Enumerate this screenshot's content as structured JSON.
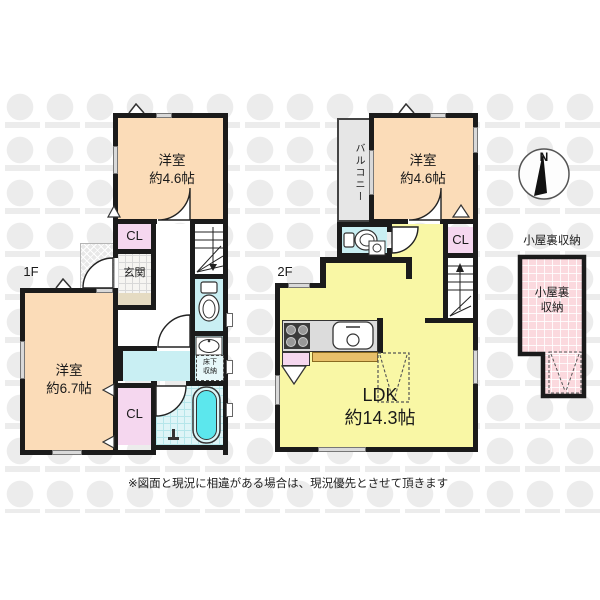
{
  "floor1": {
    "label": "1F",
    "room1": {
      "name": "洋室",
      "size": "約4.6帖"
    },
    "cl1": "CL",
    "genkan": "玄関",
    "room2": {
      "name": "洋室",
      "size": "約6.7帖"
    },
    "cl2": "CL",
    "underfloor": {
      "line1": "床下",
      "line2": "収納"
    }
  },
  "floor2": {
    "label": "2F",
    "balcony": "バルコニー",
    "room": {
      "name": "洋室",
      "size": "約4.6帖"
    },
    "cl": "CL",
    "ldk": {
      "name": "LDK",
      "size": "約14.3帖"
    }
  },
  "attic": {
    "caption": "小屋裏収納",
    "room": {
      "line1": "小屋裏",
      "line2": "収納"
    }
  },
  "compass": {
    "north": "N"
  },
  "footer": {
    "disclaimer": "※図面と現況に相違がある場合は、現況優先とさせて頂きます"
  },
  "colors": {
    "wall": "#1b1b1b",
    "room_peach": "#fbdcb8",
    "ldk_yellow": "#f9f7a5",
    "closet_pink": "#f5d7ef",
    "wet_area_cyan": "#c9eff3",
    "bathtub_cyan": "#5ce7ed",
    "attic_pink": "#fbd9de",
    "balcony_gray": "#e6e6e6",
    "counter_tan": "#e9c06a",
    "watermark_gray": "#ececec"
  },
  "icons": [
    "compass-icon",
    "toilet-icon",
    "washbasin-icon",
    "bathtub-icon",
    "sink-icon",
    "stove-icon",
    "stairs-down-icon",
    "stairs-up-icon",
    "door-arc-icon",
    "ladder-marker-icon",
    "roof-vent-icon",
    "closet-door-icon",
    "shower-icon"
  ]
}
